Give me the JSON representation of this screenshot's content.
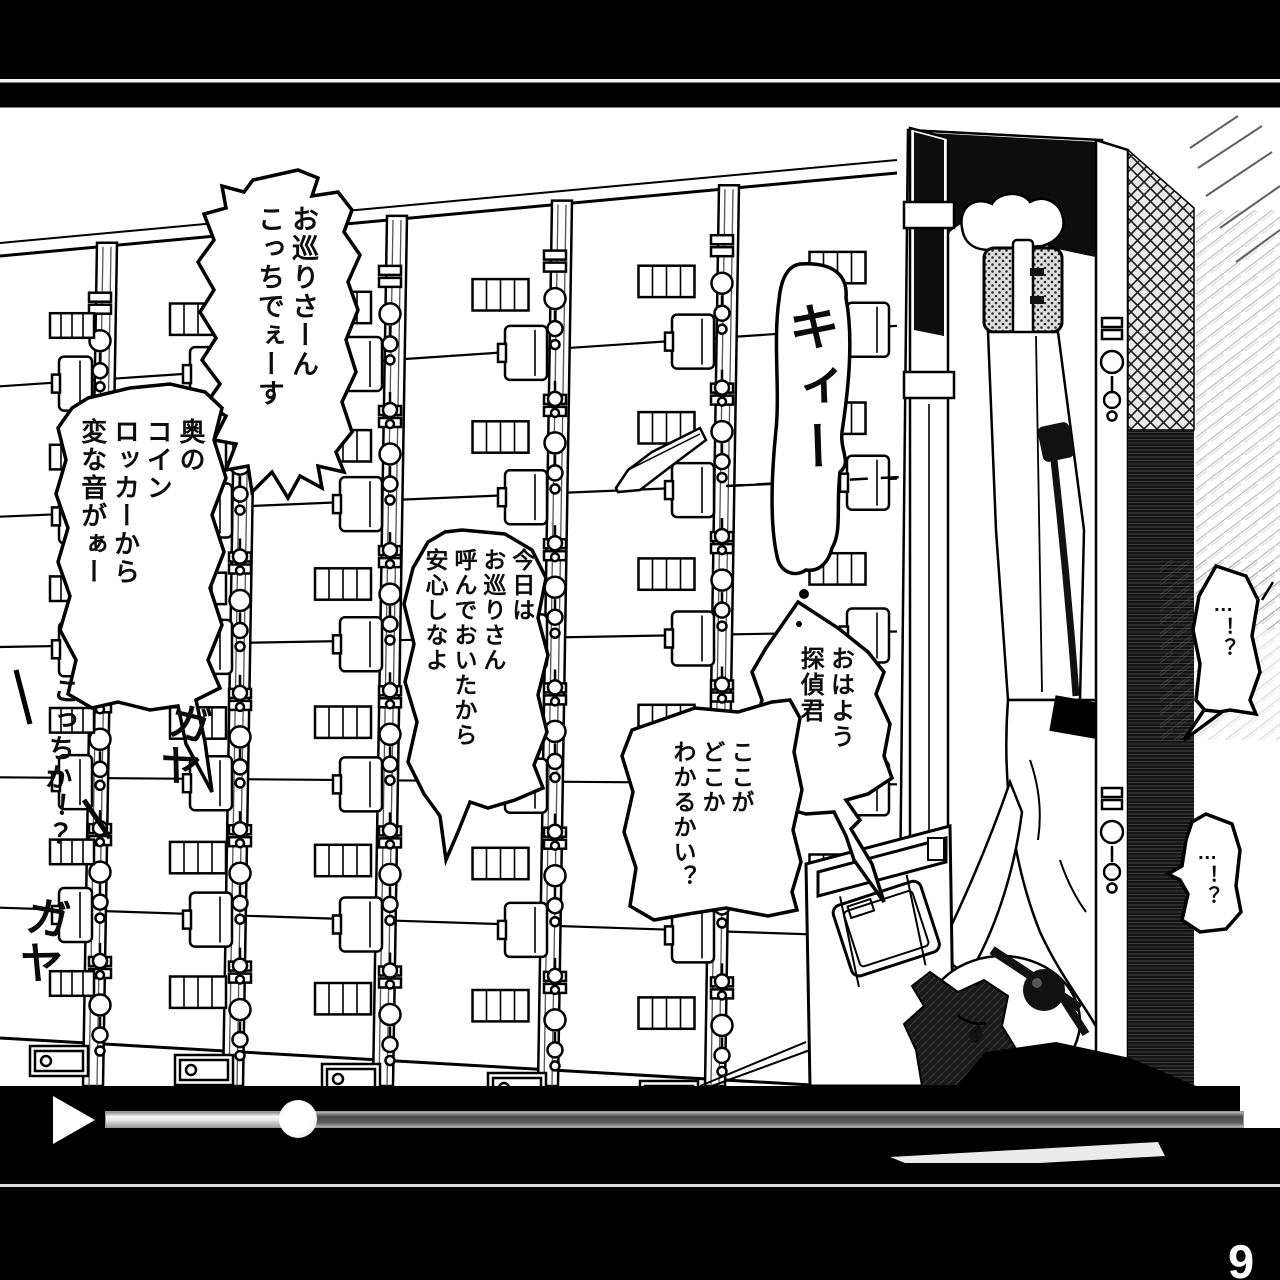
{
  "page": {
    "number": "9"
  },
  "panel": {
    "bubbles": [
      {
        "name": "bubble-cop-call",
        "text": "お巡りさーん\nこっちでぇーす"
      },
      {
        "name": "bubble-strange-noise",
        "text": "奥の\nコイン\nロッカーから\n変な音がぁー"
      },
      {
        "name": "bubble-called-police",
        "text": "今日は\nお巡りさん\n呼んでおいたから\n安心しなよ"
      },
      {
        "name": "bubble-good-morning",
        "text": "おはよう\n探偵君"
      },
      {
        "name": "bubble-where-is-this",
        "text": "ここが\nどこか\nわかるかい？"
      },
      {
        "name": "bubble-shock-1",
        "text": "…！？"
      },
      {
        "name": "bubble-shock-2",
        "text": "…！？"
      }
    ],
    "sfx": [
      {
        "name": "sfx-creak",
        "text": "キィー"
      },
      {
        "name": "sfx-crowd-1",
        "text": "ガヤ"
      },
      {
        "name": "sfx-crowd-2",
        "text": "ガヤ"
      },
      {
        "name": "sfx-over-here",
        "text": "こっちか！？"
      }
    ]
  },
  "player": {
    "play_icon": "play-triangle",
    "progress_percent": 17
  },
  "colors": {
    "background": "#000000",
    "paper": "#ffffff",
    "ink": "#0d0d0d",
    "track": "#4a4a4a",
    "track_border": "#999999",
    "fill_light": "#f2f2f2"
  }
}
